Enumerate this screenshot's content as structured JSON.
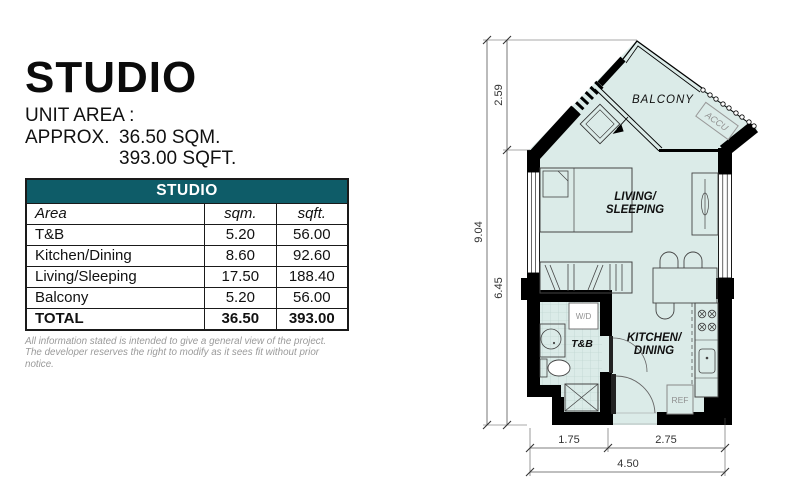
{
  "left_panel": {
    "title": "STUDIO",
    "unit_area_label": "UNIT AREA :",
    "approx_label": "APPROX.",
    "sqm_value": "36.50 SQM.",
    "sqft_value": "393.00 SQFT.",
    "table": {
      "header": "STUDIO",
      "columns": [
        "Area",
        "sqm.",
        "sqft."
      ],
      "rows": [
        {
          "area": "T&B",
          "sqm": "5.20",
          "sqft": "56.00"
        },
        {
          "area": "Kitchen/Dining",
          "sqm": "8.60",
          "sqft": "92.60"
        },
        {
          "area": "Living/Sleeping",
          "sqm": "17.50",
          "sqft": "188.40"
        },
        {
          "area": "Balcony",
          "sqm": "5.20",
          "sqft": "56.00"
        },
        {
          "area": "TOTAL",
          "sqm": "36.50",
          "sqft": "393.00"
        }
      ]
    },
    "disclaimer": {
      "line1": "All information stated is intended to give a general view of the project.",
      "line2": "The developer reserves the right to modify as it sees fit without prior notice."
    }
  },
  "floorplan": {
    "labels": {
      "balcony": "BALCONY",
      "accu": "ACCU",
      "living_line1": "LIVING/",
      "living_line2": "SLEEPING",
      "tb": "T&B",
      "kitchen_line1": "KITCHEN/",
      "kitchen_line2": "DINING",
      "wd": "W/D",
      "ref": "REF"
    },
    "dimensions": {
      "overall_height": "9.04",
      "balcony_depth": "2.59",
      "main_depth": "6.45",
      "bottom_left": "1.75",
      "bottom_right": "2.75",
      "bottom_overall": "4.50"
    }
  },
  "colors": {
    "table_header_bg": "#0e5c68",
    "table_header_text": "#ffffff",
    "floor_fill": "#dbebe8",
    "wall": "#000000"
  }
}
